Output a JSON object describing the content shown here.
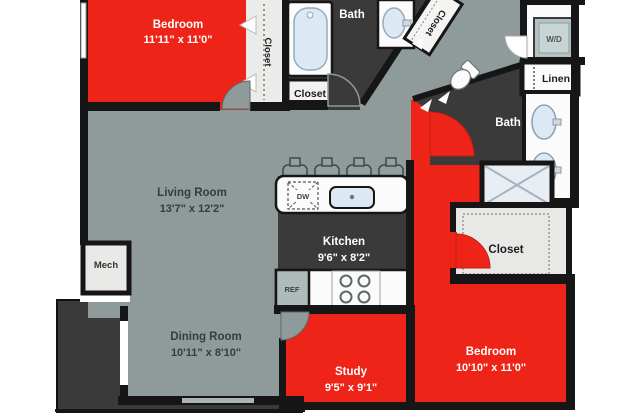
{
  "floorplan": {
    "rooms": {
      "bedroom_top": {
        "name": "Bedroom",
        "dims": "11'11\" x 11'0\""
      },
      "closet_bedroom_top": {
        "name": "Closet"
      },
      "bath_top": {
        "name": "Bath"
      },
      "closet_bath_top": {
        "name": "Closet"
      },
      "closet_entry": {
        "name": "Closet"
      },
      "laundry": {
        "name": "W/D"
      },
      "linen": {
        "name": "Linen"
      },
      "bath_right": {
        "name": "Bath"
      },
      "living_room": {
        "name": "Living Room",
        "dims": "13'7\" x 12'2\""
      },
      "kitchen": {
        "name": "Kitchen",
        "dims": "9'6\" x  8'2\""
      },
      "mech": {
        "name": "Mech"
      },
      "dining_room": {
        "name": "Dining Room",
        "dims": "10'11\" x 8'10\""
      },
      "study": {
        "name": "Study",
        "dims": "9'5\" x 9'1\""
      },
      "bedroom_bottom": {
        "name": "Bedroom",
        "dims": "10'10\" x 11'0\""
      },
      "closet_walkin": {
        "name": "Closet"
      }
    },
    "appliances": {
      "dishwasher": "DW",
      "refrigerator": "REF"
    },
    "colors": {
      "room_red": "#ee2418",
      "floor_gray": "#8f9a9a",
      "room_dark": "#3a3a3a",
      "wall_black": "#161616",
      "room_light": "#ebebe9",
      "fixture_blue": "#dce8f3"
    }
  }
}
